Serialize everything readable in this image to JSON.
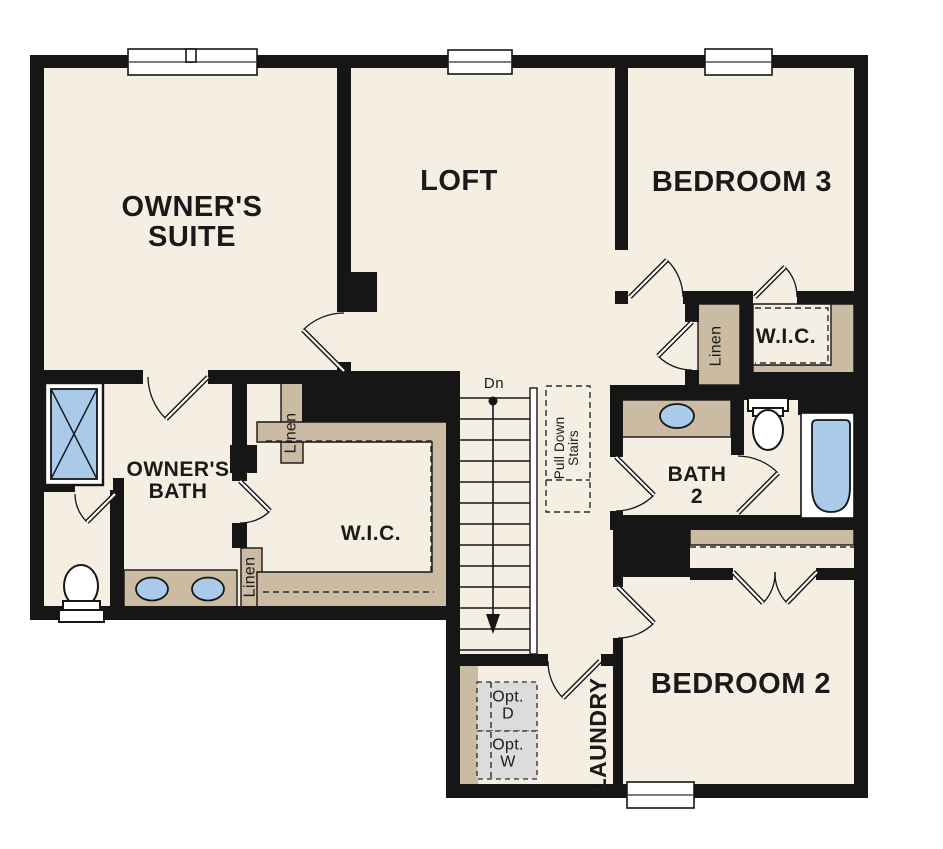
{
  "plan": {
    "title": "Second floor plan",
    "rooms": {
      "owners_suite": {
        "label": "OWNER'S\nSUITE"
      },
      "loft": {
        "label": "LOFT"
      },
      "bedroom3": {
        "label": "BEDROOM 3"
      },
      "wic_bedroom3": {
        "label": "W.I.C."
      },
      "owners_bath": {
        "label": "OWNER'S\nBATH"
      },
      "wic_owners": {
        "label": "W.I.C."
      },
      "bath2": {
        "label": "BATH\n2"
      },
      "bedroom2": {
        "label": "BEDROOM 2"
      },
      "laundry": {
        "label": "LAUNDRY"
      }
    },
    "closets": {
      "linen_owners_bath": {
        "label": "Linen"
      },
      "linen_owners_wic": {
        "label": "Linen"
      },
      "linen_bedroom3": {
        "label": "Linen"
      }
    },
    "annotations": {
      "stairs_down": {
        "label": "Dn"
      },
      "pull_down_stairs": {
        "label": "Pull Down\nStairs"
      },
      "optional_dryer": {
        "label": "Opt.\nD"
      },
      "optional_washer": {
        "label": "Opt.\nW"
      }
    },
    "colors": {
      "background": "#ffffff",
      "floor": "#f5eee2",
      "cabinet_tan": "#cbbba2",
      "wall": "#161616",
      "fixture_blue": "#a9cbe9",
      "optional_gray": "#dcdcdc"
    }
  }
}
